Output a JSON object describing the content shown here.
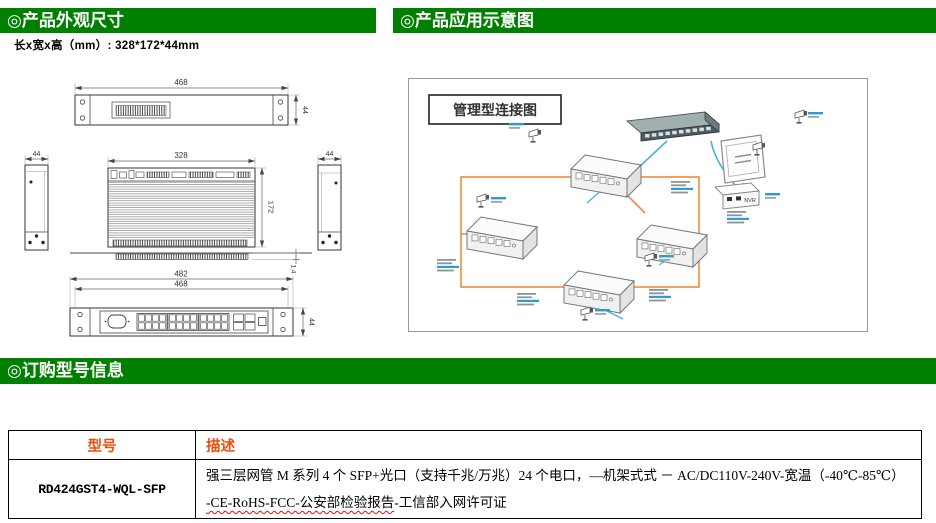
{
  "colors": {
    "header_green": "#008000",
    "table_header_orange": "#E8500A",
    "fiber_orange": "#EE8A3C",
    "cable_blue": "#45B0E6",
    "label_blue": "#2E9BD6"
  },
  "sections": {
    "appearance_title": "◎产品外观尺寸",
    "application_title": "◎产品应用示意图",
    "ordering_title": "◎订购型号信息"
  },
  "appearance": {
    "size_note": "长x宽x高（mm）: 328*172*44mm"
  },
  "drawings": {
    "rear_view": {
      "width_dim": "468",
      "height_dim": "44"
    },
    "side_view_left": {
      "width_dim": "44"
    },
    "side_view_right": {
      "width_dim": "44"
    },
    "top_view": {
      "width_dim": "328",
      "depth_dim": "172",
      "panel_thickness_dim": "1.4"
    },
    "front_view": {
      "outer_width_dim": "482",
      "inner_width_dim": "468",
      "height_dim": "44"
    }
  },
  "diagram": {
    "title": "管理型连接图",
    "nvr_label": "NVR"
  },
  "order_table": {
    "headers": {
      "model": "型号",
      "description": "描述"
    },
    "row": {
      "model": "RD424GST4-WQL-SFP",
      "description_line1": "强三层网管 M 系列 4 个 SFP+光口（支持千兆/万兆）24 个电口，—机架式式 － AC/DC110V-240V-宽温（-40℃-85℃）",
      "description_line2_underlined": "-CE-RoHS-FCC-公安部检验报告",
      "description_line2_rest": "-工信部入网许可证"
    }
  }
}
